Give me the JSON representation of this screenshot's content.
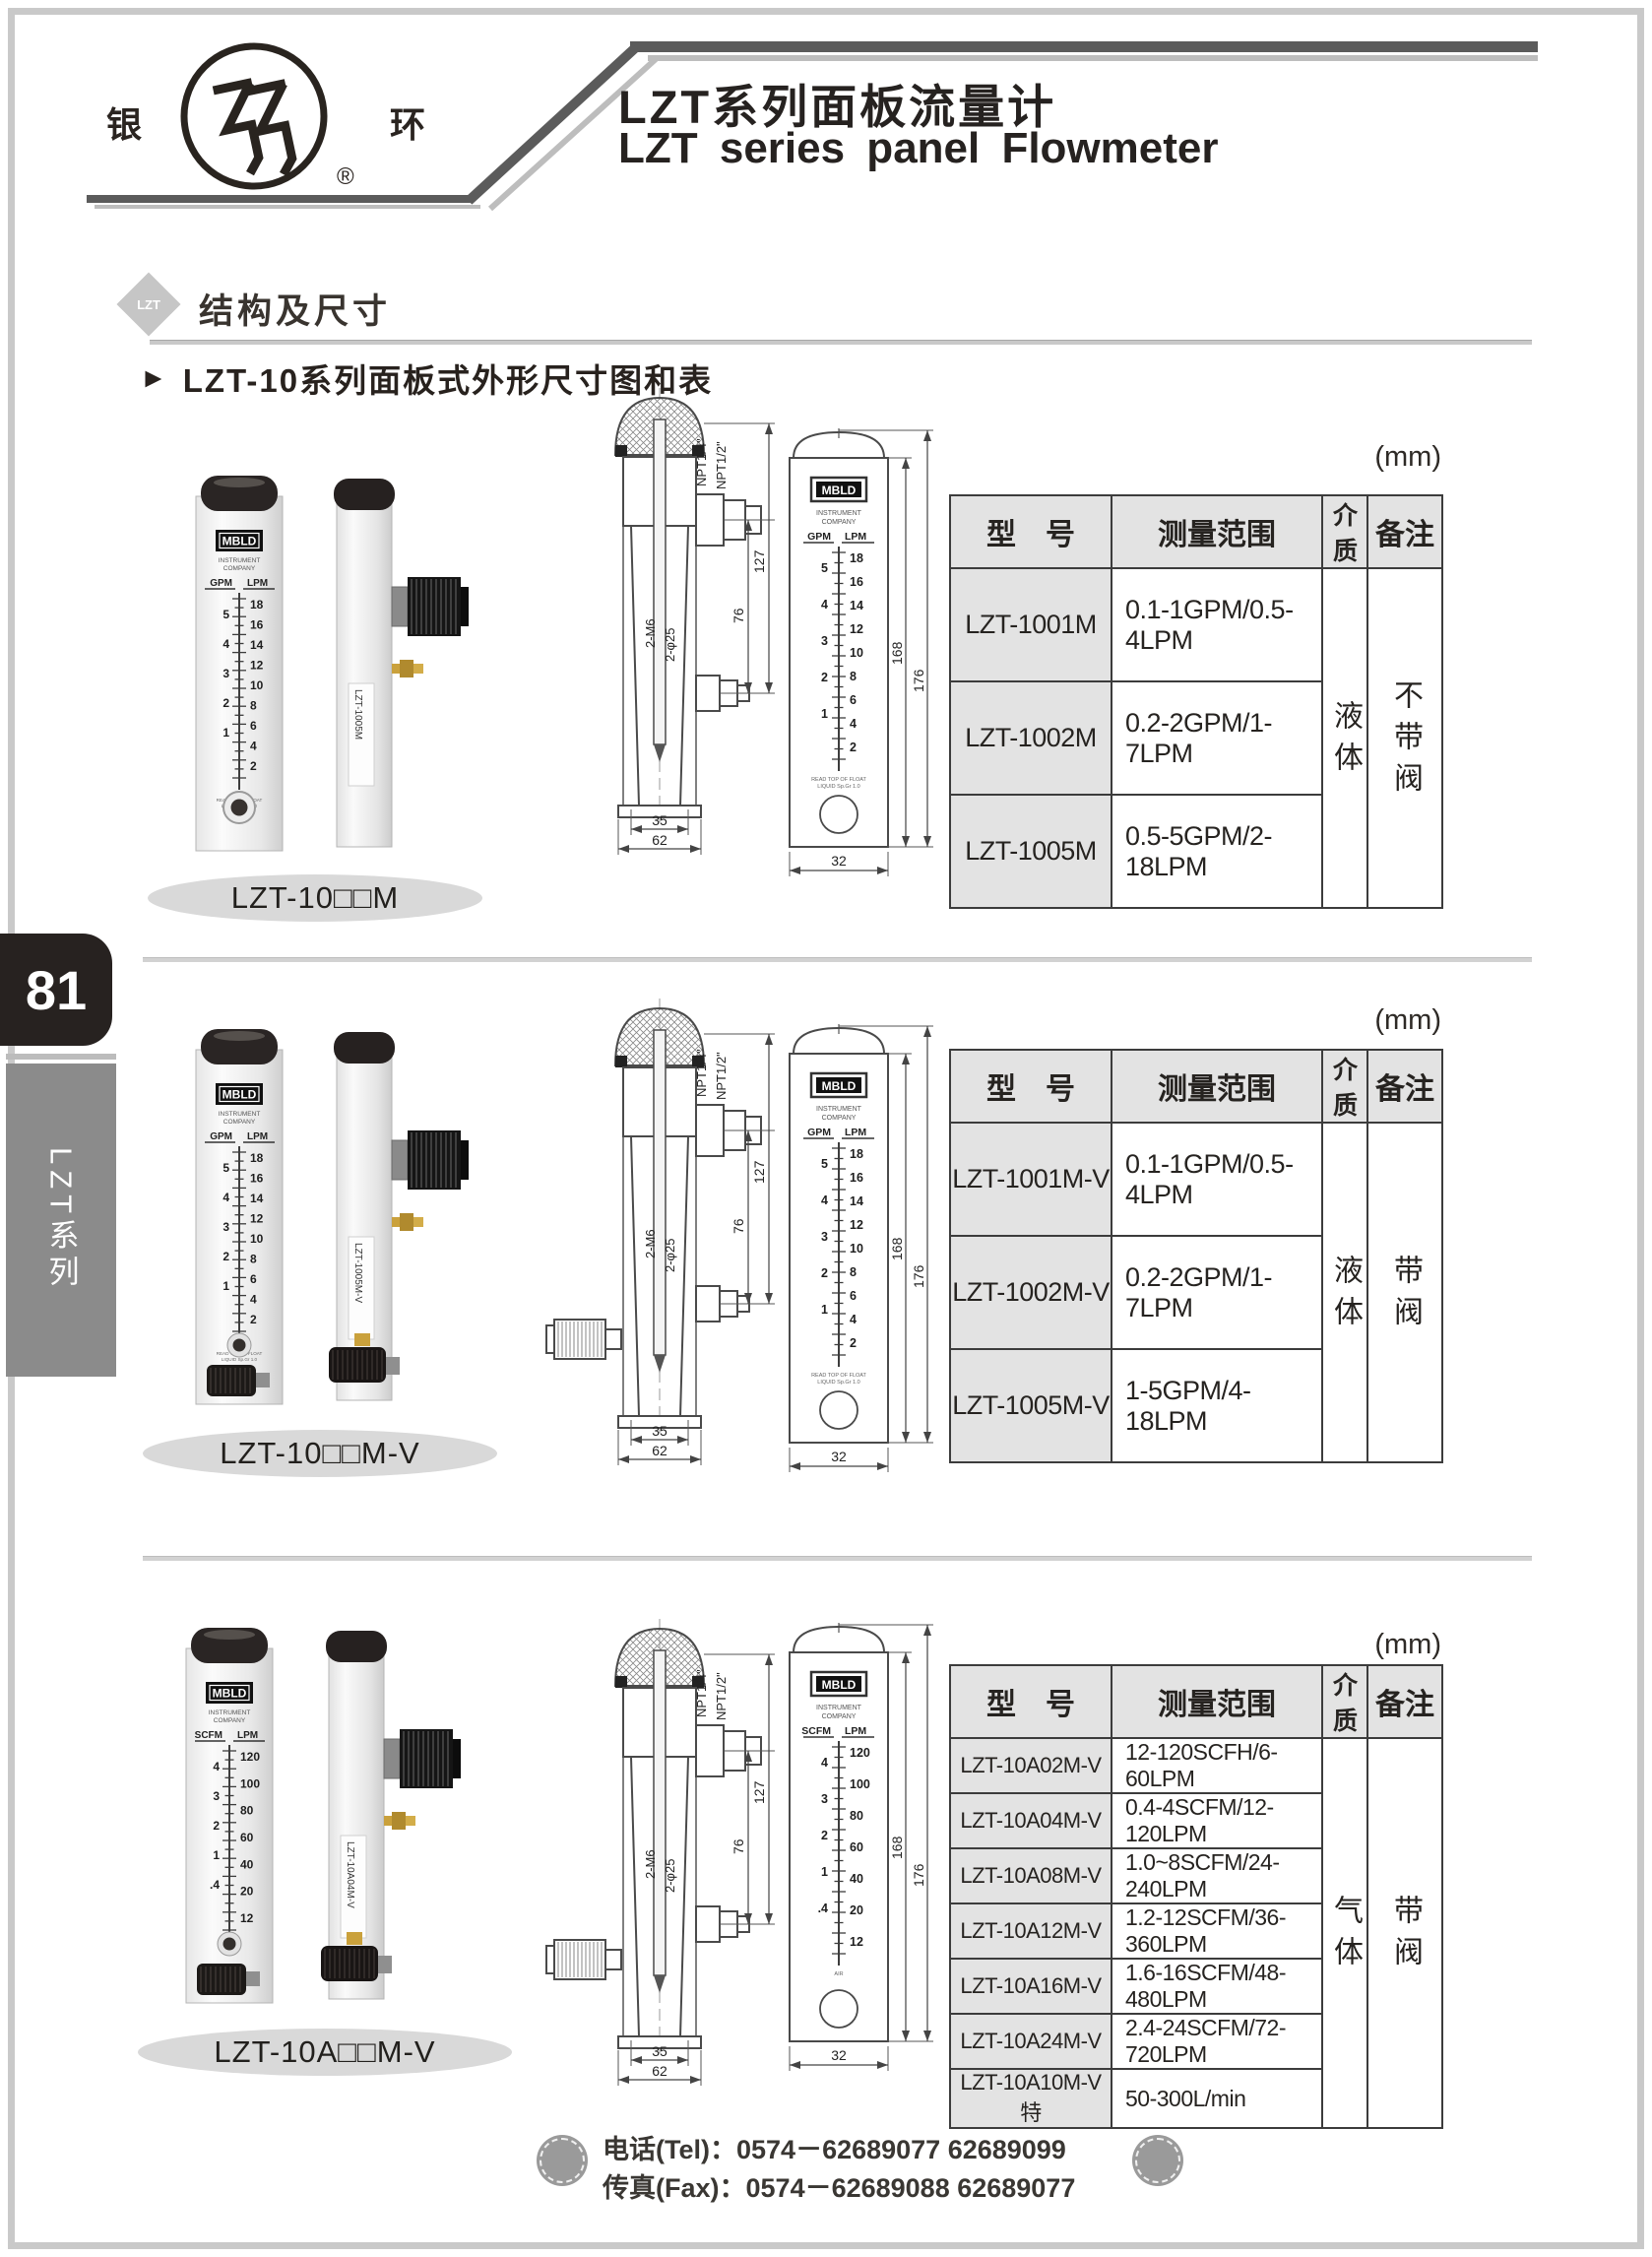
{
  "page": {
    "page_number": "81",
    "series_tab": "LZT系列"
  },
  "header": {
    "logo_left": "银",
    "logo_right": "环",
    "registered": "®",
    "title_cn": "LZT系列面板流量计",
    "title_en": "LZT series panel Flowmeter"
  },
  "section_header": {
    "badge": "LZT",
    "title": "结构及尺寸"
  },
  "subsection": {
    "marker": "►",
    "title": "LZT-10系列面板式外形尺寸图和表"
  },
  "table_headers": {
    "model": "型　号",
    "range": "测量范围",
    "medium": "介质",
    "note": "备注"
  },
  "drawing": {
    "npt_small": "NPT1/4\"",
    "npt_large": "NPT1/2\"",
    "dim_height_127": "127",
    "dim_height_76": "76",
    "thread_label": "2-M6",
    "hole_label": "2-φ25",
    "dim_width_35": "35",
    "dim_width_62": "62",
    "dim_168": "168",
    "dim_176": "176",
    "dim_32": "32"
  },
  "sections": [
    {
      "caption": "LZT-10□□M",
      "unit_note": "(mm)",
      "medium": "液体",
      "note": "不带阀",
      "has_valve": false,
      "rows": [
        {
          "model": "LZT-1001M",
          "range": "0.1-1GPM/0.5-4LPM"
        },
        {
          "model": "LZT-1002M",
          "range": "0.2-2GPM/1-7LPM"
        },
        {
          "model": "LZT-1005M",
          "range": "0.5-5GPM/2-18LPM"
        }
      ],
      "photo": {
        "brand": "MBLD",
        "brand_line1": "INSTRUMENT",
        "brand_line2": "COMPANY",
        "unit_left": "GPM",
        "unit_right": "LPM",
        "scale_left": [
          "5",
          "4",
          "3",
          "2",
          "1"
        ],
        "scale_right": [
          "18",
          "16",
          "14",
          "12",
          "10",
          "8",
          "6",
          "4",
          "2"
        ],
        "float_note": "READ TOP OF FLOAT",
        "float_note2": "LIQUID Sp.Gr 1.0",
        "side_label": "LZT-1005M"
      }
    },
    {
      "caption": "LZT-10□□M-V",
      "unit_note": "(mm)",
      "medium": "液体",
      "note": "带阀",
      "has_valve": true,
      "rows": [
        {
          "model": "LZT-1001M-V",
          "range": "0.1-1GPM/0.5-4LPM"
        },
        {
          "model": "LZT-1002M-V",
          "range": "0.2-2GPM/1-7LPM"
        },
        {
          "model": "LZT-1005M-V",
          "range": "1-5GPM/4-18LPM"
        }
      ],
      "photo": {
        "brand": "MBLD",
        "brand_line1": "INSTRUMENT",
        "brand_line2": "COMPANY",
        "unit_left": "GPM",
        "unit_right": "LPM",
        "scale_left": [
          "5",
          "4",
          "3",
          "2",
          "1"
        ],
        "scale_right": [
          "18",
          "16",
          "14",
          "12",
          "10",
          "8",
          "6",
          "4",
          "2"
        ],
        "float_note": "READ TOP OF FLOAT",
        "float_note2": "LIQUID Sp.Gr 1.0",
        "side_label": "LZT-1005M-V"
      }
    },
    {
      "caption": "LZT-10A□□M-V",
      "unit_note": "(mm)",
      "medium": "气体",
      "note": "带阀",
      "has_valve": true,
      "rows": [
        {
          "model": "LZT-10A02M-V",
          "range": "12-120SCFH/6-60LPM"
        },
        {
          "model": "LZT-10A04M-V",
          "range": "0.4-4SCFM/12-120LPM"
        },
        {
          "model": "LZT-10A08M-V",
          "range": "1.0~8SCFM/24-240LPM"
        },
        {
          "model": "LZT-10A12M-V",
          "range": "1.2-12SCFM/36-360LPM"
        },
        {
          "model": "LZT-10A16M-V",
          "range": "1.6-16SCFM/48-480LPM"
        },
        {
          "model": "LZT-10A24M-V",
          "range": "2.4-24SCFM/72-720LPM"
        },
        {
          "model": "LZT-10A10M-V特",
          "range": "50-300L/min"
        }
      ],
      "photo": {
        "brand": "MBLD",
        "brand_line1": "INSTRUMENT",
        "brand_line2": "COMPANY",
        "unit_left": "SCFM",
        "unit_right": "LPM",
        "scale_left": [
          "4",
          "3",
          "2",
          "1",
          ".4"
        ],
        "scale_right": [
          "120",
          "100",
          "80",
          "60",
          "40",
          "20",
          "12"
        ],
        "float_note": "AIR",
        "float_note2": "",
        "side_label": "LZT-10A04M-V"
      }
    }
  ],
  "footer": {
    "tel_label": "电话(Tel)：",
    "tel_value": "0574－62689077  62689099",
    "fax_label": "传真(Fax)：",
    "fax_value": "0574－62689088  62689077"
  }
}
